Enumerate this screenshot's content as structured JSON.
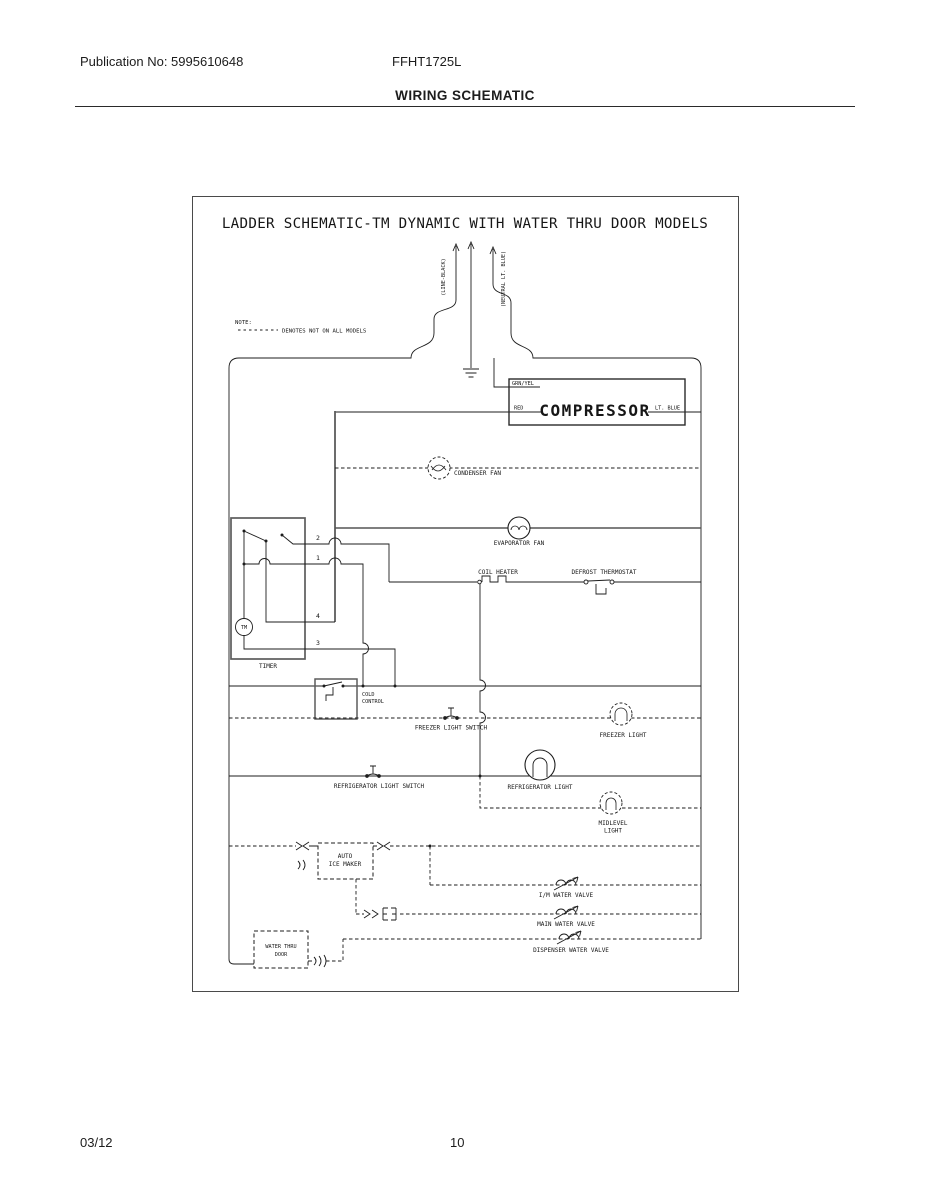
{
  "page": {
    "publication": "Publication No: 5995610648",
    "model": "FFHT1725L",
    "section_title": "WIRING SCHEMATIC",
    "footer_date": "03/12",
    "footer_page": "10"
  },
  "schematic": {
    "title": "LADDER SCHEMATIC-TM DYNAMIC WITH WATER THRU DOOR MODELS",
    "note_label": "NOTE:",
    "note_text": "DENOTES NOT ON ALL MODELS",
    "wires": {
      "line": "(LINE-BLACK)",
      "neutral": "(NEUTRAL LT. BLUE)",
      "grn_yel": "GRN/YEL",
      "red": "RED",
      "lt_blue": "LT. BLUE"
    },
    "terminals": {
      "t1": "1",
      "t2": "2",
      "t3": "3",
      "t4": "4"
    },
    "components": {
      "compressor": "COMPRESSOR",
      "condenser_fan": "CONDENSER FAN",
      "evaporator_fan": "EVAPORATOR FAN",
      "coil_heater": "COIL HEATER",
      "defrost_thermostat": "DEFROST THERMOSTAT",
      "timer": "TIMER",
      "timer_motor": "TM",
      "cold_control_line1": "COLD",
      "cold_control_line2": "CONTROL",
      "freezer_light_switch": "FREEZER LIGHT SWITCH",
      "freezer_light": "FREEZER LIGHT",
      "refrigerator_light_switch": "REFRIGERATOR LIGHT SWITCH",
      "refrigerator_light": "REFRIGERATOR LIGHT",
      "midlevel_light_line1": "MIDLEVEL",
      "midlevel_light_line2": "LIGHT",
      "ice_maker_line1": "AUTO",
      "ice_maker_line2": "ICE MAKER",
      "im_water_valve": "I/M WATER VALVE",
      "main_water_valve": "MAIN WATER VALVE",
      "dispenser_water_valve": "DISPENSER WATER VALVE",
      "water_thru_door_line1": "WATER THRU",
      "water_thru_door_line2": "DOOR"
    }
  }
}
